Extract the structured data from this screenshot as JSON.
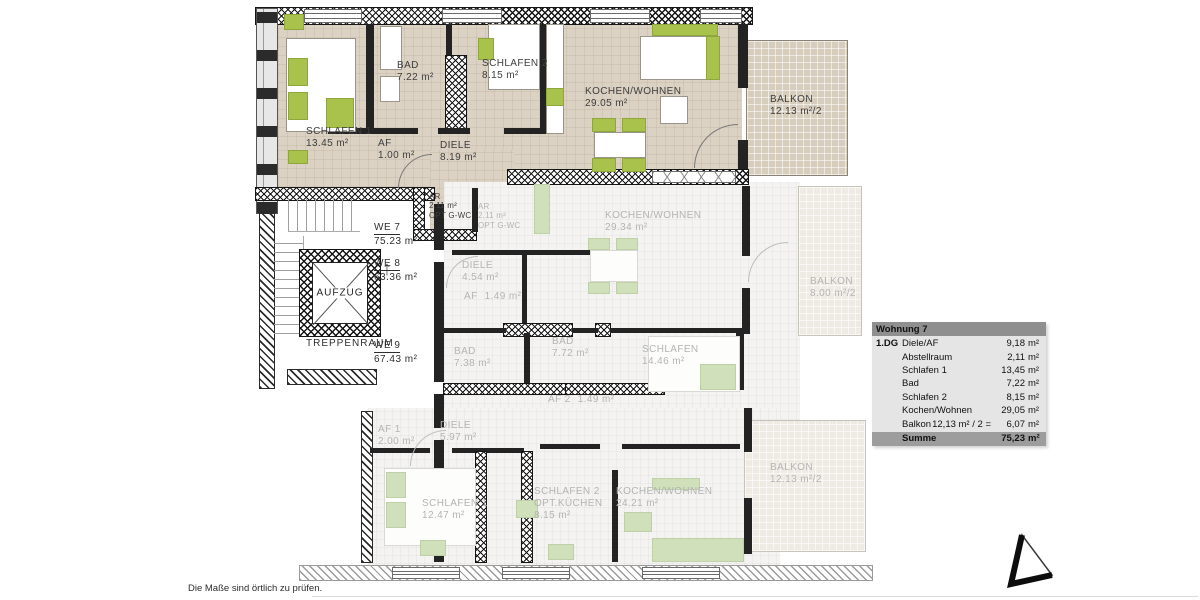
{
  "plan": {
    "core": {
      "elevator": "AUFZUG",
      "stairwell": "TREPPENRAUM",
      "up_arrow": "↑"
    },
    "units": {
      "we7": {
        "id": "WE 7",
        "area": "75.23 m²"
      },
      "we8": {
        "id": "WE 8",
        "area": "63.36 m²"
      },
      "we9": {
        "id": "WE 9",
        "area": "67.43 m²"
      }
    },
    "top": {
      "schlafen1": {
        "name": "SCHLAFEN 1",
        "area": "13.45 m²"
      },
      "bad": {
        "name": "BAD",
        "area": "7.22 m²"
      },
      "schlafen2": {
        "name": "SCHLAFEN 2",
        "area": "8.15 m²"
      },
      "kochen": {
        "name": "KOCHEN/WOHNEN",
        "area": "29.05 m²"
      },
      "balkon": {
        "name": "BALKON",
        "area": "12.13 m²/2"
      },
      "af": {
        "name": "AF",
        "area": "1.00 m²"
      },
      "diele": {
        "name": "DIELE",
        "area": "8.19 m²"
      },
      "ar": {
        "name": "AR",
        "area": "2.11 m²",
        "note": "OPT G-WC"
      }
    },
    "middle": {
      "ar": {
        "name": "AR",
        "area": "2.11 m²",
        "note": "OPT G-WC"
      },
      "kochen": {
        "name": "KOCHEN/WOHNEN",
        "area": "29.34 m²"
      },
      "diele": {
        "name": "DIELE",
        "area": "4.54 m²"
      },
      "af": {
        "name": "AF",
        "area": "1.49 m²"
      },
      "bad1": {
        "name": "BAD",
        "area": "7.38 m²"
      },
      "bad2": {
        "name": "BAD",
        "area": "7.72 m²"
      },
      "schlafen": {
        "name": "SCHLAFEN",
        "area": "14.46 m²"
      },
      "af2": {
        "name": "AF 2",
        "area": "1.49 m²"
      },
      "balkon": {
        "name": "BALKON",
        "area": "8.00 m²/2"
      }
    },
    "bottom": {
      "af1": {
        "name": "AF 1",
        "area": "2.00 m²"
      },
      "diele": {
        "name": "DIELE",
        "area": "5.97 m²"
      },
      "schlafen1": {
        "name": "SCHLAFEN 1",
        "area": "12.47 m²"
      },
      "schlafen2": {
        "name": "SCHLAFEN 2",
        "note": "OPT.KÜCHEN",
        "area": "8.15 m²"
      },
      "kochen": {
        "name": "KOCHEN/WOHNEN",
        "area": "24.21 m²"
      },
      "balkon": {
        "name": "BALKON",
        "area": "12.13 m²/2"
      }
    }
  },
  "legend": {
    "title": "Wohnung 7",
    "rows": [
      {
        "floor": "1.DG",
        "label": "Diele/AF",
        "detail": "",
        "value": "9,18",
        "unit": "m²"
      },
      {
        "floor": "",
        "label": "Abstellraum",
        "detail": "",
        "value": "2,11",
        "unit": "m²"
      },
      {
        "floor": "",
        "label": "Schlafen 1",
        "detail": "",
        "value": "13,45",
        "unit": "m²"
      },
      {
        "floor": "",
        "label": "Bad",
        "detail": "",
        "value": "7,22",
        "unit": "m²"
      },
      {
        "floor": "",
        "label": "Schlafen 2",
        "detail": "",
        "value": "8,15",
        "unit": "m²"
      },
      {
        "floor": "",
        "label": "Kochen/Wohnen",
        "detail": "",
        "value": "29,05",
        "unit": "m²"
      },
      {
        "floor": "",
        "label": "Balkon",
        "detail": "12,13 m² / 2 =",
        "value": "6,07",
        "unit": "m²"
      }
    ],
    "sum": {
      "label": "Summe",
      "value": "75,23",
      "unit": "m²"
    }
  },
  "footer": {
    "note": "Die Maße sind örtlich zu prüfen."
  },
  "colors": {
    "highlight_floor": "#dcd2c3",
    "balcony_floor": "#d7cdbc",
    "accent_green": "#a8c24c",
    "muted_green": "#cfe0bb",
    "muted_label": "#b4b4b4",
    "table_header": "#8f8f8f",
    "table_body": "#e5e5e5",
    "table_sum": "#9d9d9d"
  }
}
